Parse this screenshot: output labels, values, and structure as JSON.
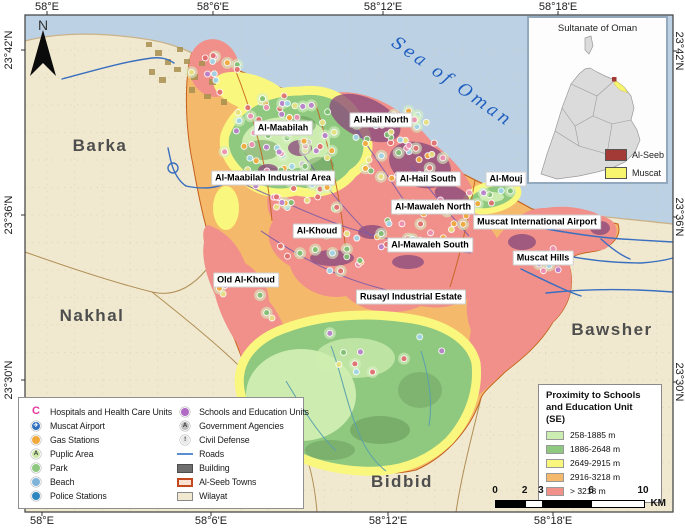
{
  "map": {
    "sea_label": "Sea of Oman",
    "north_label": "N",
    "coordinates": {
      "top": [
        {
          "label": "58°E",
          "x": 47
        },
        {
          "label": "58°6'E",
          "x": 213
        },
        {
          "label": "58°12'E",
          "x": 383
        },
        {
          "label": "58°18'E",
          "x": 558
        }
      ],
      "bottom": [
        {
          "label": "58°E",
          "x": 42
        },
        {
          "label": "58°6'E",
          "x": 211
        },
        {
          "label": "58°12'E",
          "x": 388
        },
        {
          "label": "58°18'E",
          "x": 553
        }
      ],
      "left": [
        {
          "label": "23°42'N",
          "y": 50
        },
        {
          "label": "23°36'N",
          "y": 215
        },
        {
          "label": "23°30'N",
          "y": 380
        }
      ],
      "right": [
        {
          "label": "23°42'N",
          "y": 51
        },
        {
          "label": "23°36'N",
          "y": 217
        },
        {
          "label": "23°30'N",
          "y": 382
        }
      ]
    },
    "regions": [
      {
        "label": "Barka",
        "x": 100,
        "y": 146
      },
      {
        "label": "Nakhal",
        "x": 92,
        "y": 316
      },
      {
        "label": "Bawsher",
        "x": 612,
        "y": 330
      },
      {
        "label": "Bidbid",
        "x": 402,
        "y": 482
      }
    ],
    "towns": [
      {
        "label": "Al-Maabilah",
        "x": 283,
        "y": 128
      },
      {
        "label": "Al-Hail North",
        "x": 381,
        "y": 120
      },
      {
        "label": "Al-Maabilah Industrial Area",
        "x": 273,
        "y": 178
      },
      {
        "label": "Al-Hail South",
        "x": 428,
        "y": 179
      },
      {
        "label": "Al-Mouj",
        "x": 506,
        "y": 179
      },
      {
        "label": "Al-Mawaleh North",
        "x": 433,
        "y": 207
      },
      {
        "label": "Muscat International Airport",
        "x": 537,
        "y": 222
      },
      {
        "label": "Al-Khoud",
        "x": 317,
        "y": 231
      },
      {
        "label": "Al-Mawaleh South",
        "x": 430,
        "y": 245
      },
      {
        "label": "Muscat Hills",
        "x": 543,
        "y": 258
      },
      {
        "label": "Old Al-Khoud",
        "x": 246,
        "y": 280
      },
      {
        "label": "Rusayl Industrial Estate",
        "x": 411,
        "y": 297
      }
    ]
  },
  "inset": {
    "title": "Sultanate of Oman",
    "legend": [
      {
        "label": "Al-Seeb",
        "color": "#a33a35"
      },
      {
        "label": "Muscat",
        "color": "#f7f56e"
      }
    ]
  },
  "legend": {
    "left_items": [
      {
        "icon": "hospital-icon",
        "glyph": "C",
        "color": "#e3379b",
        "label": "Hospitals and Health Care Units"
      },
      {
        "icon": "airport-icon",
        "glyph": "✈",
        "color": "#2f6fbe",
        "label": "Muscat Airport"
      },
      {
        "icon": "gas-station-icon",
        "glyph": "",
        "color": "#f2a93b",
        "label": "Gas Stations"
      },
      {
        "icon": "public-area-icon",
        "glyph": "A",
        "color": "#cbe6a8",
        "label": "Puplic Area"
      },
      {
        "icon": "park-icon",
        "glyph": "",
        "color": "#8fc87f",
        "label": "Park"
      },
      {
        "icon": "beach-icon",
        "glyph": "",
        "color": "#7fb3d8",
        "label": "Beach"
      },
      {
        "icon": "police-station-icon",
        "glyph": "",
        "color": "#2e86c1",
        "label": "Police Stations"
      }
    ],
    "right_items": [
      {
        "icon": "school-icon",
        "glyph": "",
        "color": "#b06bc4",
        "label": "Schools and Education Units"
      },
      {
        "icon": "government-icon",
        "glyph": "A",
        "color": "#bdbdbd",
        "label": "Government Agencies"
      },
      {
        "icon": "civil-defense-icon",
        "glyph": "!",
        "color": "#e8e8e8",
        "label": "Civil Defense"
      },
      {
        "icon": "roads-line",
        "color": "#5b8fd4",
        "label": "Roads"
      },
      {
        "icon": "building-swatch",
        "color": "#6e6e6e",
        "label": "Building"
      },
      {
        "icon": "alseeb-swatch",
        "color": "#fbe3d3",
        "border": "#c4481f",
        "label": "Al-Seeb Towns"
      },
      {
        "icon": "wilayat-swatch",
        "color": "#f0e9cf",
        "border": "#8a8a8a",
        "label": "Wilayat"
      }
    ]
  },
  "proximity": {
    "line1": "Proximity to Schools",
    "line2": "and Education Unit",
    "line3": "(SE)",
    "classes": [
      {
        "color": "#ccedb1",
        "label": "258-1885 m"
      },
      {
        "color": "#8fc87f",
        "label": "1886-2648 m"
      },
      {
        "color": "#faf77e",
        "label": "2649-2915 m"
      },
      {
        "color": "#f5b96b",
        "label": "2916-3218 m"
      },
      {
        "color": "#f2908a",
        "label": "> 3218 m"
      }
    ]
  },
  "scalebar": {
    "ticks": [
      "0",
      "2",
      "3",
      "6",
      "10"
    ],
    "fractions": [
      0,
      0.2,
      0.31,
      0.65,
      1
    ],
    "unit": "KM"
  },
  "colors": {
    "sea": "#bcd2e4",
    "wilayat": "#f0e9cf",
    "zone_red": "#f1908a",
    "zone_orange": "#f5b96b",
    "zone_yellow": "#faf77e",
    "zone_green": "#8fc87f",
    "zone_lightgreen": "#cdedb0",
    "road_blue": "#3a6fc0",
    "town_border": "#c4601c"
  },
  "scatter": {
    "palette": [
      "#ed8fb1",
      "#7fbf72",
      "#f2a93b",
      "#b97fcc",
      "#e8e27f",
      "#e06e6e",
      "#9fd5e8"
    ],
    "clusters": [
      {
        "cx": 278,
        "cy": 135,
        "rx": 62,
        "ry": 40,
        "n": 55
      },
      {
        "cx": 395,
        "cy": 148,
        "rx": 55,
        "ry": 40,
        "n": 45
      },
      {
        "cx": 300,
        "cy": 190,
        "rx": 55,
        "ry": 25,
        "n": 25
      },
      {
        "cx": 430,
        "cy": 220,
        "rx": 45,
        "ry": 22,
        "n": 22
      },
      {
        "cx": 345,
        "cy": 250,
        "rx": 70,
        "ry": 22,
        "n": 20
      },
      {
        "cx": 212,
        "cy": 75,
        "rx": 30,
        "ry": 22,
        "n": 12
      },
      {
        "cx": 492,
        "cy": 196,
        "rx": 24,
        "ry": 10,
        "n": 8
      },
      {
        "cx": 250,
        "cy": 300,
        "rx": 40,
        "ry": 25,
        "n": 8
      },
      {
        "cx": 380,
        "cy": 350,
        "rx": 70,
        "ry": 35,
        "n": 10
      },
      {
        "cx": 545,
        "cy": 260,
        "rx": 25,
        "ry": 15,
        "n": 6
      }
    ]
  }
}
